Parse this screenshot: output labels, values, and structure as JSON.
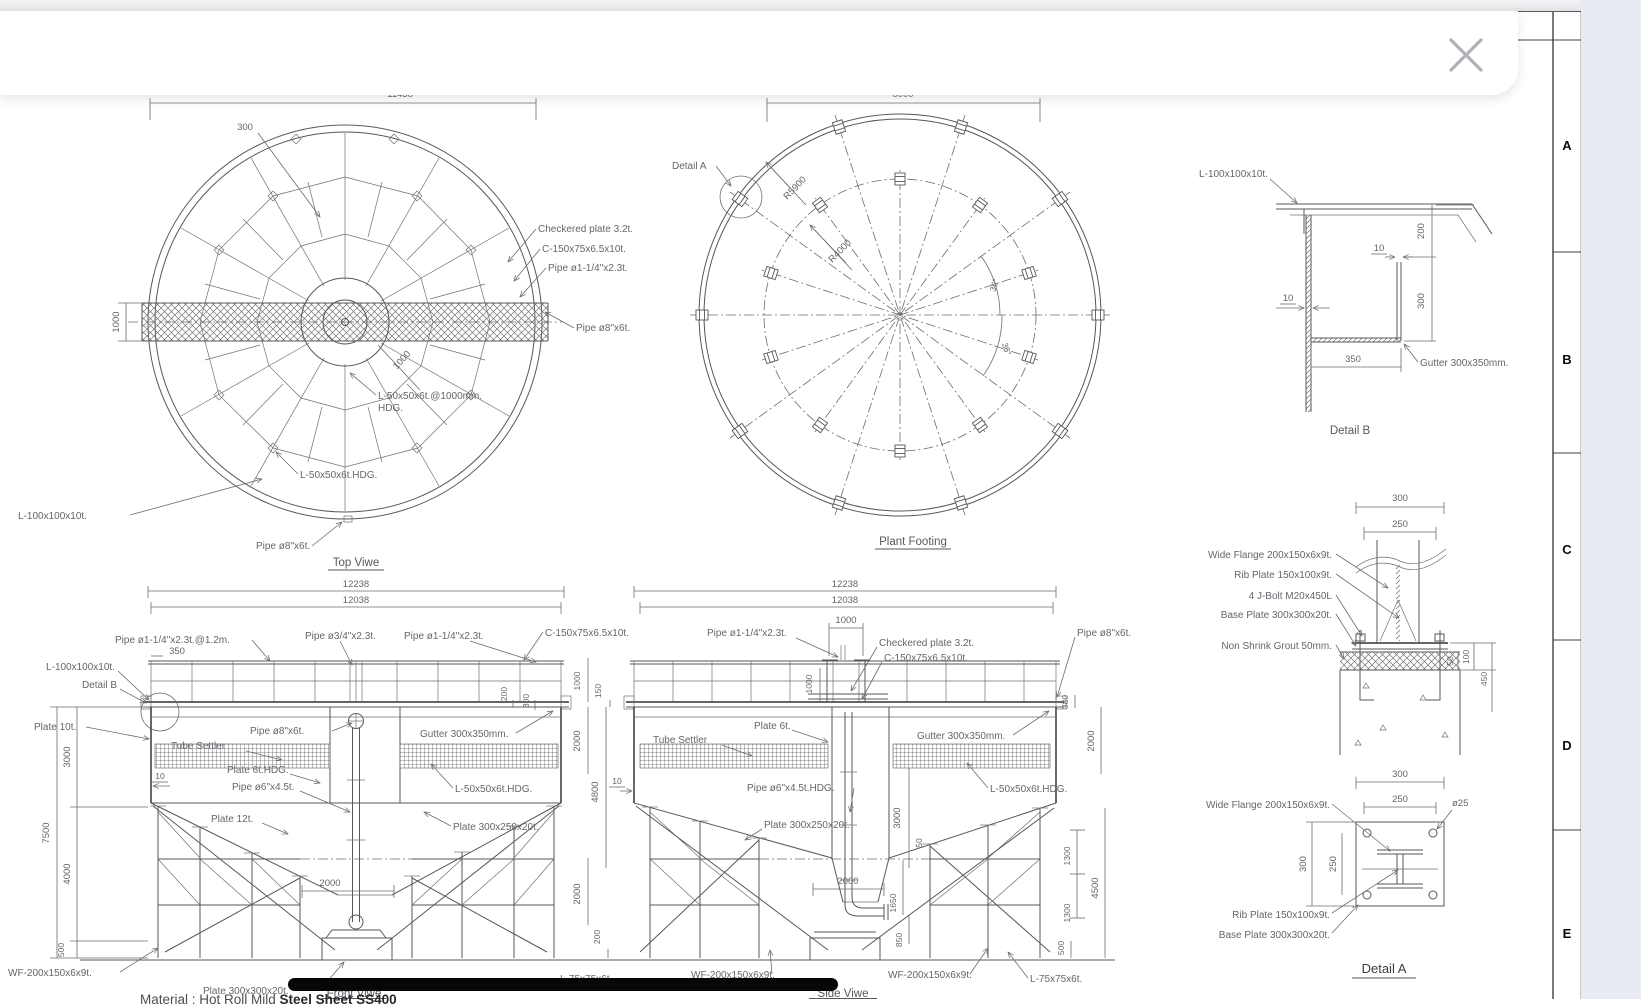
{
  "dialog": {
    "close_icon": "✕"
  },
  "zones": {
    "letters": [
      "A",
      "B",
      "C",
      "D",
      "E"
    ]
  },
  "titles": {
    "top_view": "Top Viwe",
    "plant_footing": "Plant Footing",
    "front_view": "Front Viwe",
    "side_view": "Side Viwe",
    "detail_a": "Detail A",
    "detail_b": "Detail B"
  },
  "labels": {
    "checkered_plate": "Checkered plate 3.2t.",
    "c_channel": "C-150x75x6.5x10t.",
    "pipe_1_14": "Pipe ø1-1/4\"x2.3t.",
    "pipe_1_14_12m": "Pipe ø1-1/4\"x2.3t.@1.2m.",
    "pipe_34": "Pipe ø3/4\"x2.3t.",
    "pipe_8": "Pipe ø8\"x6t.",
    "pipe_6": "Pipe ø6\"x4.5t.",
    "pipe_6_hdg": "Pipe ø6\"x4.5t.HDG.",
    "angle_50_1000": "L-50x50x6t.@1000mm.",
    "hdg": "HDG.",
    "angle_50_hdg": "L-50x50x6t.HDG.",
    "angle_100": "L-100x100x10t.",
    "angle_75": "L-75x75x6t.",
    "plate_10t": "Plate 10t.",
    "plate_6t": "Plate 6t.",
    "plate_6t_hdg": "Plate 6t.HDG.",
    "plate_12t": "Plate 12t.",
    "plate_300_250": "Plate 300x250x20t.",
    "plate_300_300": "Plate 300x300x20t.",
    "tube_settler": "Tube Settler",
    "gutter": "Gutter 300x350mm.",
    "wide_flange": "Wide Flange 200x150x6x9t.",
    "rib_plate": "Rib Plate 150x100x9t.",
    "j_bolt": "4 J-Bolt M20x450L",
    "base_plate": "Base Plate 300x300x20t.",
    "grout": "Non Shrink Grout 50mm.",
    "wf": "WF-200x150x6x9t.",
    "detail_a_ref": "Detail A",
    "detail_b_ref": "Detail B",
    "r5900": "R5900",
    "r4000": "R4000",
    "angle_36": "36°",
    "dia_25": "ø25"
  },
  "dims": {
    "d10": "10",
    "d50": "50",
    "d100": "100",
    "d150": "150",
    "d200": "200",
    "d250": "250",
    "d300": "300",
    "d350": "350",
    "d380": "380",
    "d450": "450",
    "d500": "500",
    "d850": "850",
    "d1000": "1000",
    "d1300": "1300",
    "d1650": "1650",
    "d2000": "2000",
    "d3000": "3000",
    "d4000": "4000",
    "d4500": "4500",
    "d4800": "4800",
    "d7500": "7500",
    "d8000": "8000",
    "d11438": "11438",
    "d12038": "12038",
    "d12238": "12238"
  },
  "note": {
    "prefix": "Material : Hot Roll Mild ",
    "bold": "Steel Sheet SS400"
  }
}
